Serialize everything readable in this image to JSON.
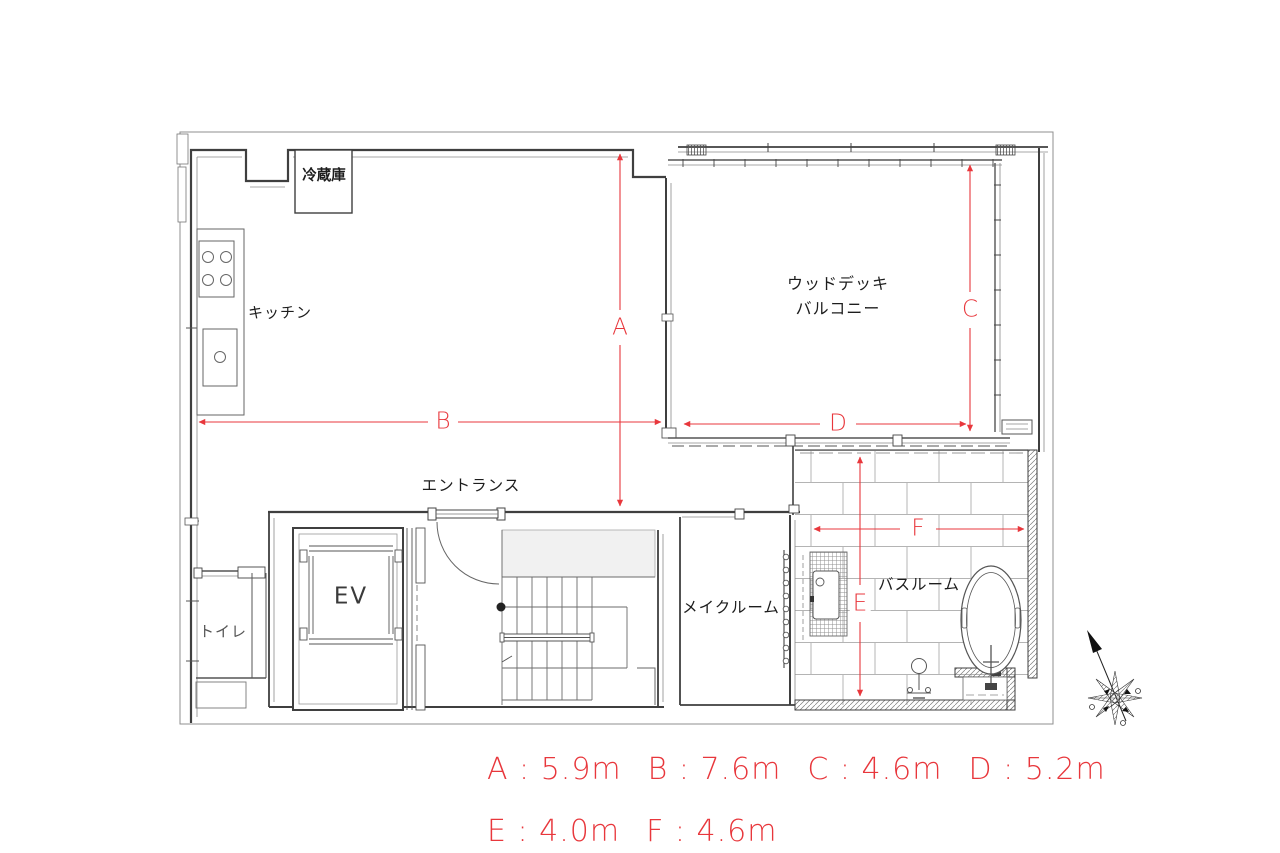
{
  "plan": {
    "labels": {
      "refrigerator": "冷蔵庫",
      "kitchen": "キッチン",
      "balcony_line1": "ウッドデッキ",
      "balcony_line2": "バルコニー",
      "entrance": "エントランス",
      "elevator": "EV",
      "toilet": "トイレ",
      "makeup_room": "メイクルーム",
      "bathroom": "バスルーム"
    }
  },
  "dimensions": {
    "accent_color": "#e8373c",
    "items": [
      {
        "label": "A",
        "value_m": 5.9,
        "display": "A : 5.9m"
      },
      {
        "label": "B",
        "value_m": 7.6,
        "display": "B : 7.6m"
      },
      {
        "label": "C",
        "value_m": 4.6,
        "display": "C : 4.6m"
      },
      {
        "label": "D",
        "value_m": 5.2,
        "display": "D : 5.2m"
      },
      {
        "label": "E",
        "value_m": 4.0,
        "display": "E : 4.0m"
      },
      {
        "label": "F",
        "value_m": 4.6,
        "display": "F : 4.6m"
      }
    ]
  },
  "icons": {
    "compass": "north-arrow-compass"
  }
}
